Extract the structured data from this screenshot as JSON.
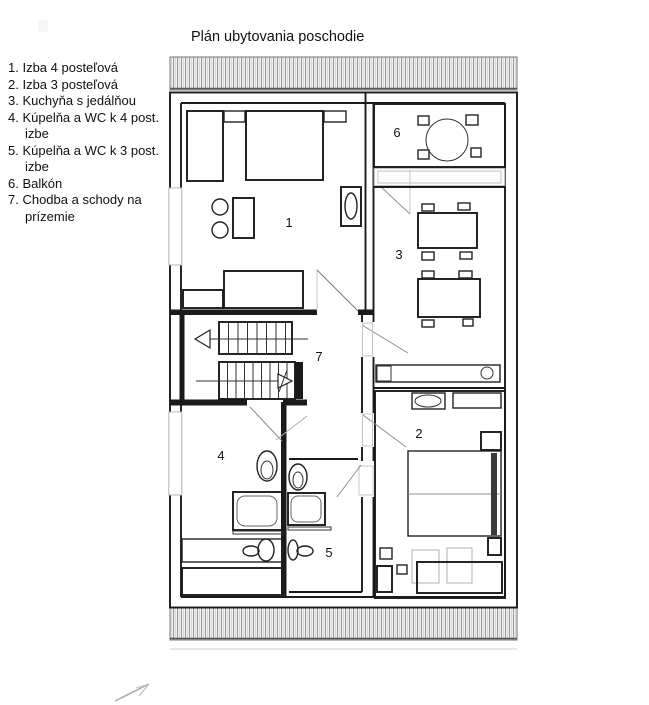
{
  "title": "Plán ubytovania poschodie",
  "legend": {
    "items": [
      "1. Izba 4 posteľová",
      "2. Izba 3 posteľová",
      "3. Kuchyňa s jedálňou",
      "4. Kúpelňa a WC k 4 post. izbe",
      "5. Kúpelňa a WC k 3 post. izbe",
      "6. Balkón",
      "7. Chodba a schody na prízemie"
    ]
  },
  "plan": {
    "room_numbers": [
      "1",
      "2",
      "3",
      "4",
      "5",
      "6",
      "7"
    ]
  },
  "colors": {
    "wall": "#1a1a1a",
    "door_swing": "#8f8f8f",
    "window": "#b5b5b5",
    "hatch_line": "#9a9a9a",
    "background": "#ffffff"
  }
}
